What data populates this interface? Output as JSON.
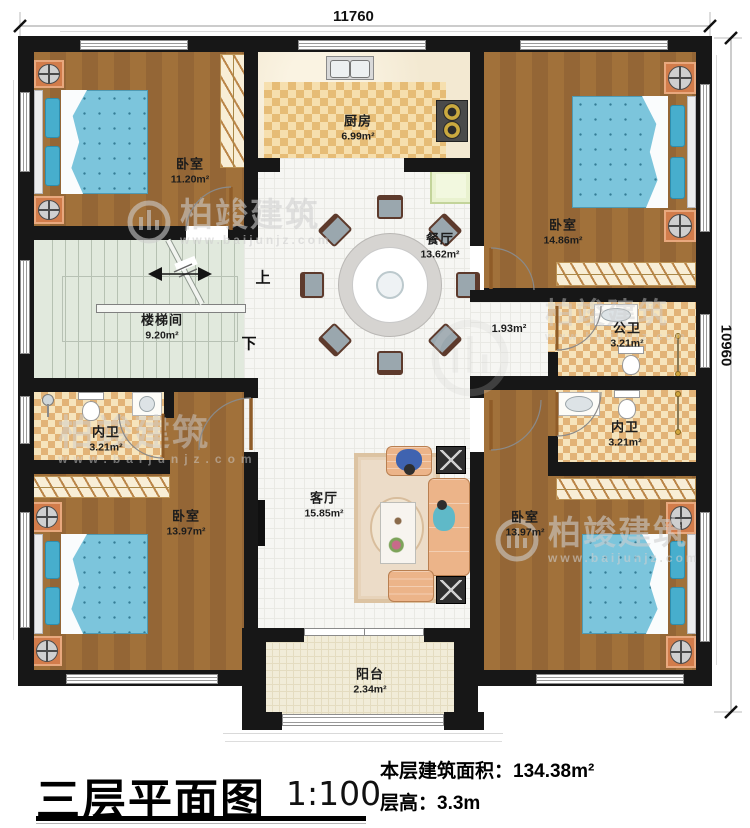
{
  "dimensions": {
    "width": "11760",
    "height": "10960"
  },
  "stairs": {
    "up": "上",
    "down": "下"
  },
  "rooms": [
    {
      "name": "卧室",
      "area": "11.20m²"
    },
    {
      "name": "厨房",
      "area": "6.99m²"
    },
    {
      "name": "卧室",
      "area": "14.86m²"
    },
    {
      "name": "餐厅",
      "area": "13.62m²"
    },
    {
      "name": "楼梯间",
      "area": "9.20m²"
    },
    {
      "name": "公卫",
      "area": "3.21m²"
    },
    {
      "name": "内卫",
      "area": "3.21m²"
    },
    {
      "name": "内卫",
      "area": "3.21m²"
    },
    {
      "name": "卧室",
      "area": "13.97m²"
    },
    {
      "name": "客厅",
      "area": "15.85m²"
    },
    {
      "name": "卧室",
      "area": "13.97m²"
    },
    {
      "name": "阳台",
      "area": "2.34m²"
    },
    {
      "name": "",
      "area": "1.93m²"
    }
  ],
  "title": {
    "text": "三层平面图",
    "scale": "1:100",
    "area_label": "本层建筑面积：",
    "area_value": "134.38m²",
    "height_label": "层高：",
    "height_value": "3.3m"
  },
  "watermark": {
    "brand": "柏竣建筑",
    "url": "www.baijunjz.com"
  }
}
